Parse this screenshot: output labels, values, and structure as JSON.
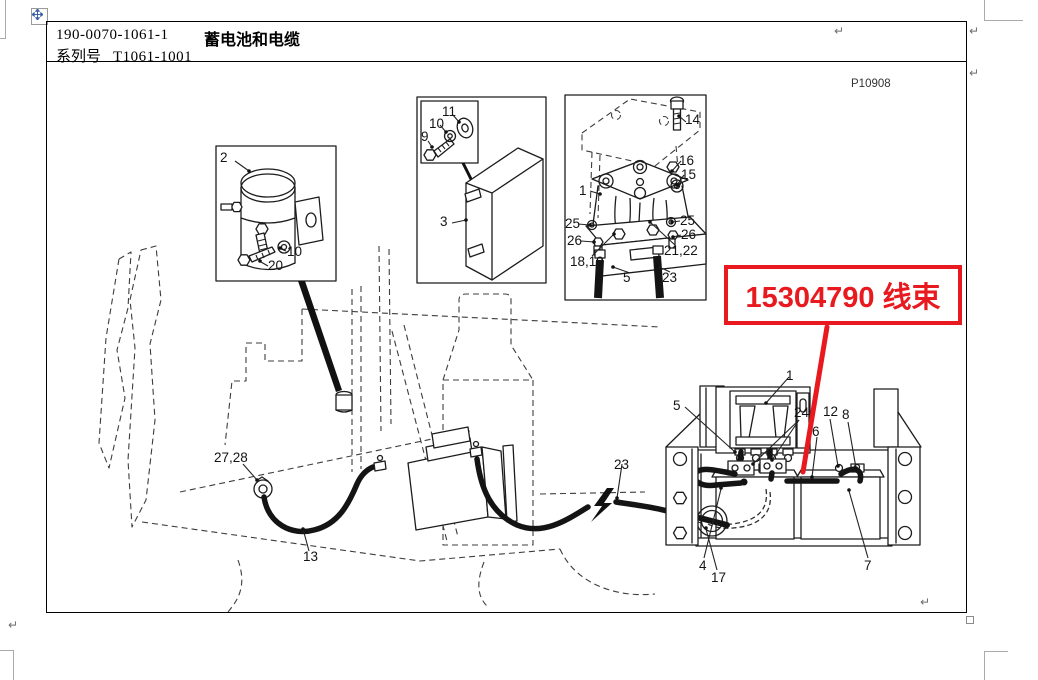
{
  "page": {
    "return_glyph": "↵",
    "return_marks": [
      {
        "x": 834,
        "y": 24
      },
      {
        "x": 969,
        "y": 24
      },
      {
        "x": 969,
        "y": 66
      },
      {
        "x": 920,
        "y": 595
      },
      {
        "x": 8,
        "y": 618
      }
    ]
  },
  "header": {
    "doc_number": "190-0070-1061-1",
    "title": "蓄电池和电缆",
    "series_label": "系列号",
    "series_value": "T1061-1001"
  },
  "figure": {
    "code": "P10908",
    "annotation": {
      "text": "15304790 线束",
      "color": "#e8191f"
    },
    "callouts": [
      {
        "label": "2",
        "x": 220,
        "y": 150
      },
      {
        "label": "10",
        "x": 287,
        "y": 244
      },
      {
        "label": "20",
        "x": 268,
        "y": 258
      },
      {
        "label": "11",
        "x": 442,
        "y": 104
      },
      {
        "label": "10",
        "x": 429,
        "y": 116
      },
      {
        "label": "9",
        "x": 421,
        "y": 129
      },
      {
        "label": "3",
        "x": 440,
        "y": 214
      },
      {
        "label": "14",
        "x": 685,
        "y": 112
      },
      {
        "label": "16",
        "x": 679,
        "y": 153
      },
      {
        "label": "15",
        "x": 681,
        "y": 167
      },
      {
        "label": "1",
        "x": 579,
        "y": 183
      },
      {
        "label": "25",
        "x": 565,
        "y": 216
      },
      {
        "label": "26",
        "x": 567,
        "y": 233
      },
      {
        "label": "25",
        "x": 680,
        "y": 213
      },
      {
        "label": "26",
        "x": 681,
        "y": 227
      },
      {
        "label": "21,22",
        "x": 664,
        "y": 243
      },
      {
        "label": "18,19",
        "x": 570,
        "y": 254
      },
      {
        "label": "5",
        "x": 623,
        "y": 270
      },
      {
        "label": "23",
        "x": 662,
        "y": 270
      },
      {
        "label": "27,28",
        "x": 214,
        "y": 450
      },
      {
        "label": "13",
        "x": 303,
        "y": 549
      },
      {
        "label": "23",
        "x": 614,
        "y": 457
      },
      {
        "label": "5",
        "x": 673,
        "y": 398
      },
      {
        "label": "1",
        "x": 786,
        "y": 368
      },
      {
        "label": "24",
        "x": 794,
        "y": 405
      },
      {
        "label": "12",
        "x": 823,
        "y": 404
      },
      {
        "label": "8",
        "x": 842,
        "y": 407
      },
      {
        "label": "6",
        "x": 812,
        "y": 424
      },
      {
        "label": "4",
        "x": 699,
        "y": 558
      },
      {
        "label": "17",
        "x": 711,
        "y": 570
      },
      {
        "label": "7",
        "x": 864,
        "y": 558
      }
    ]
  }
}
